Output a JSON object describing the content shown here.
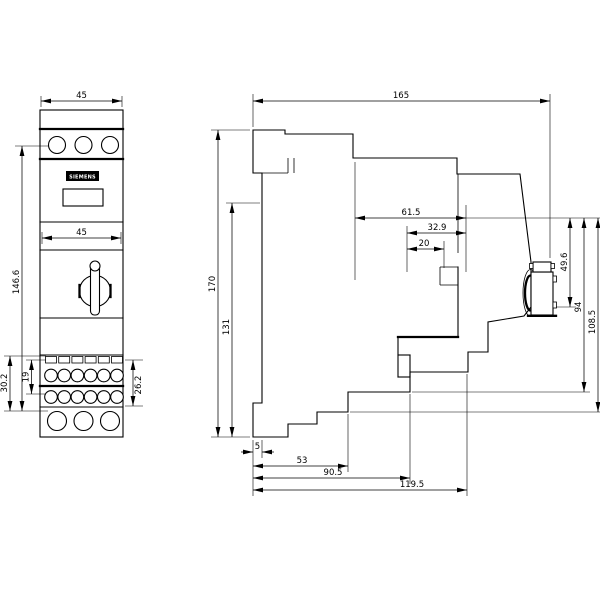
{
  "views": {
    "front": {
      "logo_text": "SIEMENS",
      "dims": {
        "overall_width": "45",
        "inner_width": "45",
        "overall_height": "146.6",
        "terminal_row_spacing": "19",
        "terminal_zone_left": "30.2",
        "terminal_zone_right": "26.2"
      }
    },
    "side": {
      "dims": {
        "overall_depth": "165",
        "upper_front_depth": "61.5",
        "knob_zone_depth": "32.9",
        "knob_depth": "20",
        "overall_height": "170",
        "rail_zone_height": "131",
        "knob_lower_height": "49.6",
        "front_mid_height": "94",
        "front_lower_height": "108.5",
        "base_step_small": "5",
        "base_step_1": "53",
        "base_step_2": "90.5",
        "base_depth": "119.5"
      }
    }
  }
}
